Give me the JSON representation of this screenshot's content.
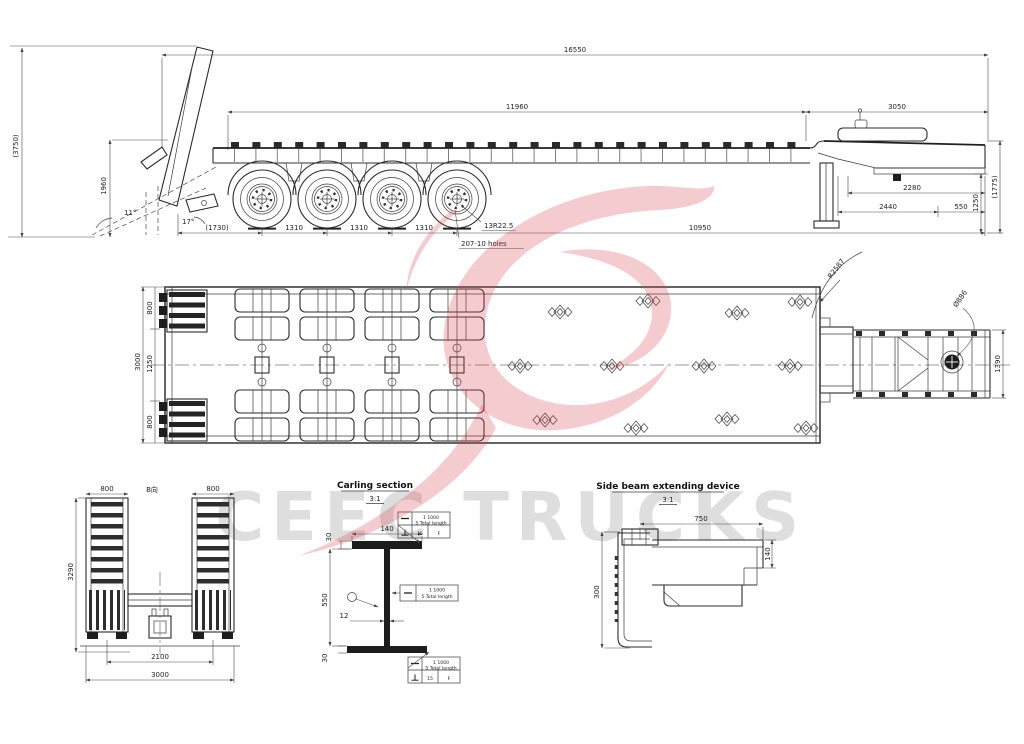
{
  "watermark": {
    "text": "CEEC TRUCKS"
  },
  "side_view": {
    "overall_length": "16550",
    "deck_length": "11960",
    "gooseneck_length": "3050",
    "ramp_raised_height": "(3750)",
    "rear_height": "1960",
    "ramp_angle": "11°",
    "tail_angle": "17°",
    "rear_overhang": "(1730)",
    "axle_spacing_1": "1310",
    "axle_spacing_2": "1310",
    "axle_spacing_3": "1310",
    "front_span": "10950",
    "tire_spec": "13R22.5",
    "rim_holes": "207-10 holes",
    "dim_2280": "2280",
    "dim_2440": "2440",
    "dim_550": "550",
    "kingpin_height": "1250",
    "gooseneck_height": "(1775)"
  },
  "plan_view": {
    "ramp_width_top": "800",
    "ramp_width_bottom": "800",
    "deck_width": "3000",
    "inner_width": "1250",
    "swing_radius": "R2587",
    "kingpin_circle": "Ø886",
    "gooseneck_width": "1390"
  },
  "rear_view": {
    "view_label": "B向",
    "ramp_width_left": "800",
    "ramp_width_right": "800",
    "overall_height": "3290",
    "ramp_center_spacing": "2100",
    "overall_width": "3000"
  },
  "carling_section": {
    "title": "Carling section",
    "scale": "3:1",
    "flange_width": "140",
    "flange_thickness": "30",
    "web_height": "550",
    "web_thickness": "12",
    "bottom_flange_thickness": "30",
    "weld_note": {
      "row1": "1  1000",
      "row2": "5  Total length",
      "weld_size": "15",
      "finish": "F"
    }
  },
  "side_beam_device": {
    "title": "Side beam extending device",
    "scale": "3:1",
    "extend_length": "750",
    "beam_height": "140",
    "device_height": "300"
  }
}
